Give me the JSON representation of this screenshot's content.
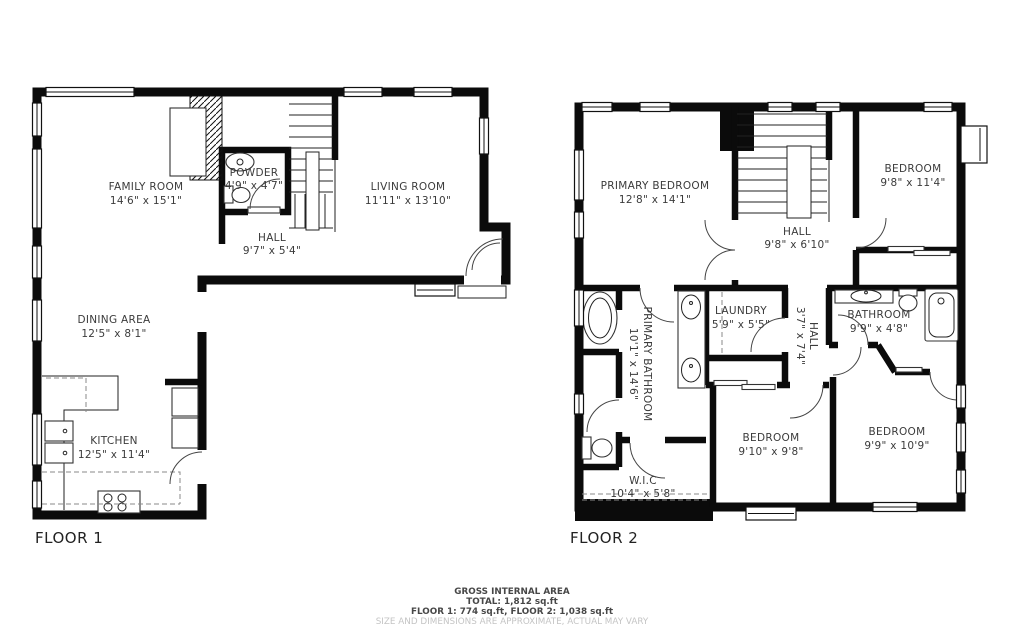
{
  "floor1": {
    "label": "FLOOR 1",
    "rooms": {
      "family_room": {
        "name": "FAMILY ROOM",
        "dims": "14'6\" x 15'1\""
      },
      "powder": {
        "name": "POWDER",
        "dims": "4'9\" x 4'7\""
      },
      "hall": {
        "name": "HALL",
        "dims": "9'7\" x 5'4\""
      },
      "living_room": {
        "name": "LIVING ROOM",
        "dims": "11'11\" x 13'10\""
      },
      "dining_area": {
        "name": "DINING AREA",
        "dims": "12'5\" x 8'1\""
      },
      "kitchen": {
        "name": "KITCHEN",
        "dims": "12'5\" x 11'4\""
      }
    }
  },
  "floor2": {
    "label": "FLOOR 2",
    "rooms": {
      "primary_bedroom": {
        "name": "PRIMARY BEDROOM",
        "dims": "12'8\" x 14'1\""
      },
      "bedroom_top_right": {
        "name": "BEDROOM",
        "dims": "9'8\" x 11'4\""
      },
      "hall": {
        "name": "HALL",
        "dims": "9'8\" x 6'10\""
      },
      "laundry": {
        "name": "LAUNDRY",
        "dims": "5'9\" x 5'5\""
      },
      "hall_small": {
        "name": "HALL",
        "dims": "3'7\" x 7'4\""
      },
      "bathroom": {
        "name": "BATHROOM",
        "dims": "9'9\" x 4'8\""
      },
      "primary_bathroom": {
        "name": "PRIMARY BATHROOM",
        "dims": "10'1\" x 14'6\""
      },
      "wic": {
        "name": "W.I.C",
        "dims": "10'4\" x 5'8\""
      },
      "bedroom_mid": {
        "name": "BEDROOM",
        "dims": "9'10\" x 9'8\""
      },
      "bedroom_right": {
        "name": "BEDROOM",
        "dims": "9'9\" x 10'9\""
      }
    }
  },
  "footer": {
    "line1": "GROSS INTERNAL AREA",
    "line2": "TOTAL: 1,812 sq.ft",
    "line3": "FLOOR 1: 774 sq.ft, FLOOR 2: 1,038 sq.ft",
    "line4": "SIZE AND DIMENSIONS ARE APPROXIMATE, ACTUAL MAY VARY"
  },
  "colors": {
    "wall": "#0b0b0b",
    "text": "#3b3b3b",
    "muted": "#c4c4c4"
  }
}
